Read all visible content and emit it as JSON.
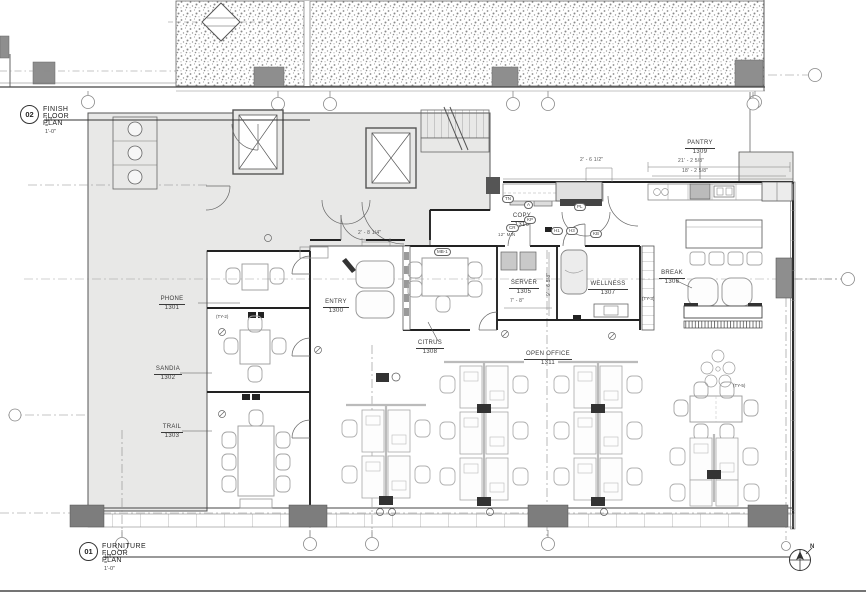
{
  "titles": [
    {
      "number": "02",
      "title": "FINISH FLOOR PLAN",
      "scale": "1/4\" = 1'-0\""
    },
    {
      "number": "01",
      "title": "FURNITURE FLOOR PLAN",
      "scale": "1/4\" = 1'-0\""
    }
  ],
  "rooms": [
    {
      "name": "PHONE",
      "number": "1301"
    },
    {
      "name": "SANDIA",
      "number": "1302"
    },
    {
      "name": "TRAIL",
      "number": "1303"
    },
    {
      "name": "ENTRY",
      "number": "1300"
    },
    {
      "name": "CITRUS",
      "number": "1308"
    },
    {
      "name": "SERVER",
      "number": "1305"
    },
    {
      "name": "WELLNESS",
      "number": "1307"
    },
    {
      "name": "COPY",
      "number": "1310"
    },
    {
      "name": "PANTRY",
      "number": "1309"
    },
    {
      "name": "BREAK",
      "number": "1306"
    },
    {
      "name": "OPEN OFFICE",
      "number": "1311"
    }
  ],
  "dimensions": {
    "entry": "2' - 8 1/4\"",
    "pantry": "2' - 6 1/2\"",
    "break_top": "21' - 2 5/8\"",
    "break_bot": "18' - 2 5/8\"",
    "server_w": "7' - 8\"",
    "server_d": "9' - 6 5/8\"",
    "min_clear": "12\" MIN"
  },
  "tags": {
    "ty2": "(TY-2)",
    "ty3": "(TY-3)",
    "ty5": "(TY-5)",
    "mb1": "MB-1",
    "tn": "TN",
    "a": "A",
    "pl": "PL",
    "kp": "KP",
    "cr": "CR",
    "h1": "H1",
    "h3": "H3",
    "kb": "KB"
  },
  "compass": {
    "north": "N"
  },
  "colors": {
    "wall": "#222222",
    "line": "#555555",
    "furniture": "#9a9a9a",
    "shade": "#e8e8e7",
    "column": "#8e8e8e",
    "paper": "#ffffff"
  }
}
